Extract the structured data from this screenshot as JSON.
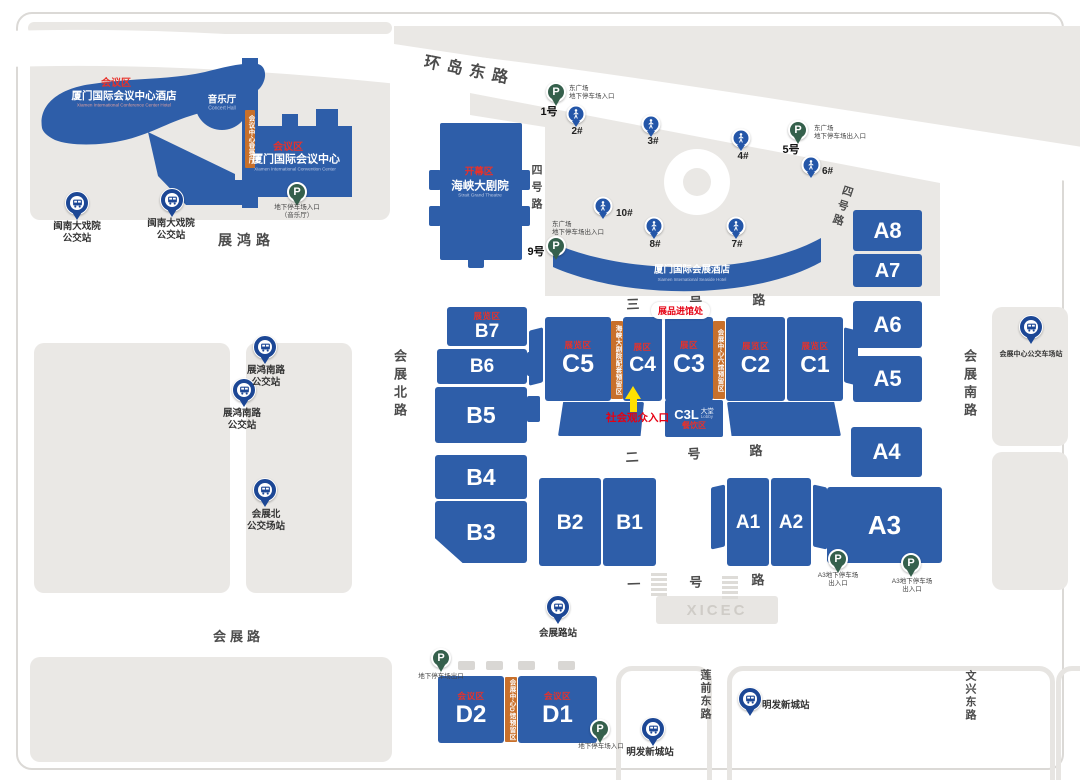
{
  "colors": {
    "building_blue": "#2e5ea9",
    "parcel_gray": "#eae8e5",
    "zone_red": "#e8312a",
    "annotation_red": "#e60012",
    "orange_strip": "#c8702b",
    "bus_pin": "#1c4795",
    "gate_pin": "#2456a8",
    "parking_green": "#35604c",
    "arrow_yellow": "#ffe100",
    "road_text": "#4c4c4c"
  },
  "icons": {
    "parking_letter": "P"
  },
  "roads": [
    {
      "id": "huandao-dong-lu",
      "text": "环岛东路",
      "x": 427,
      "y": 48,
      "size": 16,
      "spacing": 7,
      "rotate": 11
    },
    {
      "id": "zhanhong-lu",
      "text": "展鸿路",
      "x": 218,
      "y": 230,
      "size": 14,
      "spacing": 5
    },
    {
      "id": "sihao-lu-west",
      "text": "四号路",
      "x": 528,
      "y": 164,
      "size": 11,
      "spacing": 6,
      "vertical": true
    },
    {
      "id": "sihao-lu-east",
      "text": "四号路",
      "x": 841,
      "y": 183,
      "size": 11,
      "spacing": 4,
      "vertical": true,
      "rotate": 18
    },
    {
      "id": "sanhao-lu",
      "text": "三号路",
      "x": 626,
      "y": 294,
      "size": 13,
      "spacing": 50,
      "rotate": -2
    },
    {
      "id": "erhao-lu",
      "text": "二号路",
      "x": 625,
      "y": 447,
      "size": 13,
      "spacing": 49,
      "rotate": -3
    },
    {
      "id": "yihao-lu",
      "text": "一号路",
      "x": 627,
      "y": 574,
      "size": 13,
      "spacing": 49,
      "rotate": -2
    },
    {
      "id": "huizhan-bei-lu",
      "text": "会展北路",
      "x": 390,
      "y": 349,
      "size": 13,
      "spacing": 5,
      "vertical": true
    },
    {
      "id": "huizhan-nan-lu",
      "text": "会展南路",
      "x": 960,
      "y": 349,
      "size": 13,
      "spacing": 5,
      "vertical": true
    },
    {
      "id": "huizhan-lu",
      "text": "会展路",
      "x": 213,
      "y": 626,
      "size": 13,
      "spacing": 4
    },
    {
      "id": "lianqian-dong-lu",
      "text": "莲前东路",
      "x": 697,
      "y": 669,
      "size": 11,
      "spacing": 2,
      "vertical": true
    },
    {
      "id": "wenxing-dong-lu",
      "text": "文兴东路",
      "x": 962,
      "y": 670,
      "size": 11,
      "spacing": 2,
      "vertical": true
    }
  ],
  "halls": [
    {
      "id": "A8",
      "x": 853,
      "y": 210,
      "w": 69,
      "h": 41,
      "size": 22
    },
    {
      "id": "A7",
      "x": 853,
      "y": 254,
      "w": 69,
      "h": 33,
      "size": 20
    },
    {
      "id": "A6",
      "x": 853,
      "y": 301,
      "w": 69,
      "h": 47,
      "size": 22
    },
    {
      "id": "A5",
      "x": 853,
      "y": 356,
      "w": 69,
      "h": 46,
      "size": 22
    },
    {
      "id": "A4",
      "x": 851,
      "y": 427,
      "w": 71,
      "h": 50,
      "size": 22
    },
    {
      "id": "A3",
      "x": 827,
      "y": 487,
      "w": 115,
      "h": 76,
      "size": 26
    },
    {
      "id": "A1",
      "x": 727,
      "y": 478,
      "w": 42,
      "h": 88,
      "size": 19
    },
    {
      "id": "A2",
      "x": 771,
      "y": 478,
      "w": 40,
      "h": 88,
      "size": 19
    },
    {
      "id": "B7",
      "x": 447,
      "y": 307,
      "w": 80,
      "h": 39,
      "size": 19,
      "zone": "展览区"
    },
    {
      "id": "B6",
      "x": 437,
      "y": 349,
      "w": 90,
      "h": 35,
      "size": 19
    },
    {
      "id": "B5",
      "x": 435,
      "y": 387,
      "w": 92,
      "h": 56,
      "size": 23
    },
    {
      "id": "B4",
      "x": 435,
      "y": 455,
      "w": 92,
      "h": 44,
      "size": 23
    },
    {
      "id": "B3",
      "x": 435,
      "y": 501,
      "w": 92,
      "h": 62,
      "size": 23,
      "clip": "polygon(0 0,100% 0,100% 100%,30% 100%,0 60%)"
    },
    {
      "id": "B2",
      "x": 539,
      "y": 478,
      "w": 62,
      "h": 88,
      "size": 21
    },
    {
      "id": "B1",
      "x": 603,
      "y": 478,
      "w": 53,
      "h": 88,
      "size": 21
    },
    {
      "id": "C5",
      "x": 545,
      "y": 317,
      "w": 66,
      "h": 84,
      "size": 25,
      "zone": "展览区"
    },
    {
      "id": "C4",
      "x": 623,
      "y": 317,
      "w": 39,
      "h": 84,
      "size": 21,
      "zone": "展区"
    },
    {
      "id": "C3",
      "x": 665,
      "y": 317,
      "w": 48,
      "h": 84,
      "size": 25,
      "zone": "展区"
    },
    {
      "id": "C2",
      "x": 726,
      "y": 317,
      "w": 59,
      "h": 84,
      "size": 23,
      "zone": "展览区"
    },
    {
      "id": "C1",
      "x": 787,
      "y": 317,
      "w": 56,
      "h": 84,
      "size": 23,
      "zone": "展览区"
    },
    {
      "id": "D2",
      "x": 438,
      "y": 676,
      "w": 66,
      "h": 67,
      "size": 24,
      "zone": "会议区"
    },
    {
      "id": "D1",
      "x": 518,
      "y": 676,
      "w": 79,
      "h": 67,
      "size": 24,
      "zone": "会议区"
    }
  ],
  "strips": [
    {
      "id": "tower-strip",
      "text": "会议中心登录厅",
      "x": 245,
      "y": 110,
      "w": 10,
      "h": 58
    },
    {
      "id": "c5-c4-strip",
      "text": "海峡大剧院配套预留区",
      "x": 611,
      "y": 321,
      "w": 12,
      "h": 78
    },
    {
      "id": "c3-c2-strip",
      "text": "会展中心六馆预留区",
      "x": 713,
      "y": 321,
      "w": 12,
      "h": 78
    },
    {
      "id": "d-strip",
      "text": "会展中心D馆预留区",
      "x": 505,
      "y": 677,
      "w": 12,
      "h": 65
    }
  ],
  "buildings": [
    {
      "n": "hotel-zone-label",
      "t": "会议区",
      "cls": "rz",
      "x": 116,
      "y": 84,
      "s": 10
    },
    {
      "n": "hotel-name",
      "t": "厦门国际会议中心酒店",
      "cls": "bn",
      "x": 124,
      "y": 96,
      "s": 10.5
    },
    {
      "n": "hotel-name-en",
      "t": "Xiamen International Conference Center Hotel",
      "cls": "be2",
      "x": 124,
      "y": 106,
      "s": 4.6
    },
    {
      "n": "concert-hall-name",
      "t": "音乐厅",
      "cls": "bn",
      "x": 222,
      "y": 100,
      "s": 9.5
    },
    {
      "n": "concert-hall-en",
      "t": "Concert Hall",
      "cls": "be",
      "x": 222,
      "y": 109,
      "s": 5
    },
    {
      "n": "convention-zone-label",
      "t": "会议区",
      "cls": "rz",
      "x": 288,
      "y": 148,
      "s": 10
    },
    {
      "n": "convention-name",
      "t": "厦门国际会议中心",
      "cls": "bn",
      "x": 296,
      "y": 160,
      "s": 11
    },
    {
      "n": "convention-name-en",
      "t": "Xiamen International Convention Center",
      "cls": "be",
      "x": 295,
      "y": 170,
      "s": 4.6
    },
    {
      "n": "theatre-zone-label",
      "t": "开幕区",
      "cls": "rz",
      "x": 479,
      "y": 172,
      "s": 9.5
    },
    {
      "n": "theatre-name",
      "t": "海峡大剧院",
      "cls": "bn",
      "x": 480,
      "y": 187,
      "s": 11.5
    },
    {
      "n": "theatre-name-en",
      "t": "Strait Grand Theatre",
      "cls": "be",
      "x": 480,
      "y": 197,
      "s": 4.8
    },
    {
      "n": "seaside-hotel-name",
      "t": "厦门国际会展酒店",
      "cls": "bn",
      "x": 692,
      "y": 270,
      "s": 9.5
    },
    {
      "n": "seaside-hotel-en",
      "t": "Xiamen International Seaside Hotel",
      "cls": "be",
      "x": 692,
      "y": 280,
      "s": 4.4
    }
  ],
  "bus_stops": [
    {
      "lines": [
        "闽南大戏院",
        "公交站"
      ],
      "px": 77,
      "py": 203,
      "lx": 77,
      "ly": 221
    },
    {
      "lines": [
        "闽南大戏院",
        "公交站"
      ],
      "px": 172,
      "py": 200,
      "lx": 171,
      "ly": 218
    },
    {
      "lines": [
        "展鸿南路",
        "公交站"
      ],
      "px": 265,
      "py": 347,
      "lx": 266,
      "ly": 365
    },
    {
      "lines": [
        "展鸿南路",
        "公交站"
      ],
      "px": 244,
      "py": 390,
      "lx": 242,
      "ly": 408
    },
    {
      "lines": [
        "会展北",
        "公交场站"
      ],
      "px": 265,
      "py": 490,
      "lx": 266,
      "ly": 509
    },
    {
      "lines": [
        "会展中心公交车场站"
      ],
      "px": 1031,
      "py": 327,
      "lx": 1031,
      "ly": 350,
      "ls": 7
    },
    {
      "lines": [
        "会展路站"
      ],
      "px": 558,
      "py": 607,
      "lx": 558,
      "ly": 628
    },
    {
      "lines": [
        "明发新城站"
      ],
      "px": 653,
      "py": 729,
      "lx": 650,
      "ly": 747
    },
    {
      "lines": [
        "明发新城站"
      ],
      "px": 750,
      "py": 699,
      "lx": 762,
      "ly": 700,
      "la": true
    }
  ],
  "parkings": [
    {
      "num": "1号",
      "nx": 549,
      "ny": 103,
      "px": 556,
      "py": 92,
      "note": [
        "东广场",
        "地下停车场入口"
      ],
      "tx": 569,
      "ty": 85,
      "ta": "left"
    },
    {
      "num": "5号",
      "nx": 791,
      "ny": 141,
      "px": 798,
      "py": 130,
      "note": [
        "东广场",
        "地下停车场出入口"
      ],
      "tx": 814,
      "ty": 125,
      "ta": "left"
    },
    {
      "num": "9号",
      "nx": 536,
      "ny": 243,
      "px": 556,
      "py": 246,
      "note": [
        "东广场",
        "地下停车场出入口"
      ],
      "tx": 552,
      "ty": 221,
      "ta": "left"
    },
    {
      "px": 297,
      "py": 192,
      "note": [
        "地下停车场入口",
        "（音乐厅）"
      ],
      "tx": 297,
      "ty": 204,
      "ta": "ctr"
    },
    {
      "px": 838,
      "py": 559,
      "note": [
        "A3地下停车场",
        "出入口"
      ],
      "tx": 838,
      "ty": 572,
      "ta": "ctr"
    },
    {
      "px": 911,
      "py": 563,
      "note": [
        "A3地下停车场",
        "出入口"
      ],
      "tx": 912,
      "ty": 578,
      "ta": "ctr"
    },
    {
      "px": 441,
      "py": 658,
      "note": [
        "地下停车场出口"
      ],
      "tx": 441,
      "ty": 673,
      "ta": "ctr"
    },
    {
      "px": 600,
      "py": 729,
      "note": [
        "地下停车场入口"
      ],
      "tx": 601,
      "ty": 743,
      "ta": "ctr"
    }
  ],
  "gates": [
    {
      "g": "2#",
      "px": 576,
      "py": 114,
      "lx": 577,
      "ly": 126
    },
    {
      "g": "3#",
      "px": 651,
      "py": 124,
      "lx": 653,
      "ly": 136
    },
    {
      "g": "4#",
      "px": 741,
      "py": 138,
      "lx": 743,
      "ly": 151
    },
    {
      "g": "6#",
      "px": 811,
      "py": 165,
      "lx": 822,
      "ly": 166,
      "la": true
    },
    {
      "g": "10#",
      "px": 603,
      "py": 206,
      "lx": 616,
      "ly": 208,
      "la": true
    },
    {
      "g": "8#",
      "px": 654,
      "py": 226,
      "lx": 655,
      "ly": 239
    },
    {
      "g": "7#",
      "px": 736,
      "py": 226,
      "lx": 737,
      "ly": 239
    }
  ],
  "annotations": {
    "goods_entrance": "展品进馆处",
    "public_entrance": "社会观众入口",
    "c3l": {
      "code": "C3L",
      "hall": "大堂",
      "lobby": "Lobby",
      "zone": "餐饮区"
    },
    "xicec": "XICEC"
  }
}
